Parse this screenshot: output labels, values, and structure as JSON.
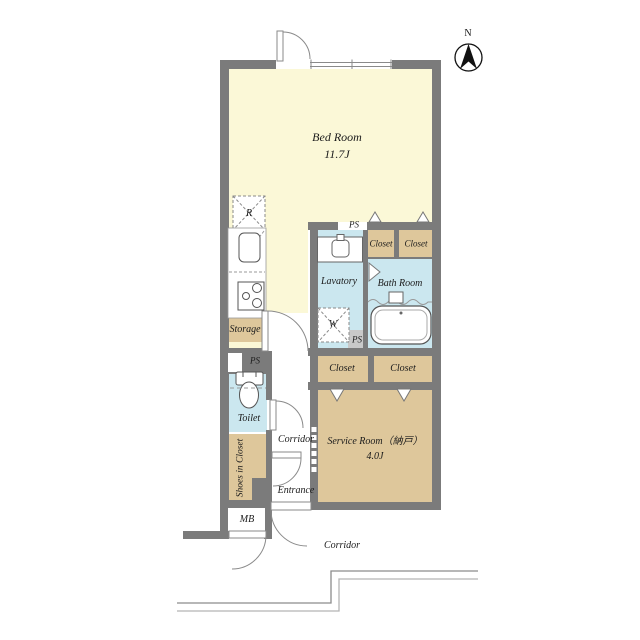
{
  "floorplan": {
    "bedroom": {
      "label": "Bed Room",
      "size": "11.7J"
    },
    "kitchen": {
      "refrigerator": "R",
      "storage": "Storage"
    },
    "sanitary": {
      "lavatory": "Lavatory",
      "bathroom": "Bath Room",
      "toilet": "Toilet",
      "washer": "W",
      "ps_top": "PS",
      "ps_lavatory": "PS",
      "ps_toilet": "PS"
    },
    "closets": {
      "top_left": "Closet",
      "top_right": "Closet",
      "mid_left": "Closet",
      "mid_right": "Closet",
      "shoes": "Shoes in Closet"
    },
    "service_room": {
      "label": "Service Room（納戸）",
      "size": "4.0J"
    },
    "circulation": {
      "corridor": "Corridor",
      "entrance": "Entrance",
      "outer_corridor": "Corridor",
      "mb": "MB"
    },
    "compass": {
      "north": "N"
    }
  },
  "colors": {
    "wall": "#7b7b7b",
    "room_yellow": "#fbf8d7",
    "room_blue": "#cbe7ef",
    "closet_tan": "#dec79b",
    "ps_gray": "#c9c9c9"
  }
}
